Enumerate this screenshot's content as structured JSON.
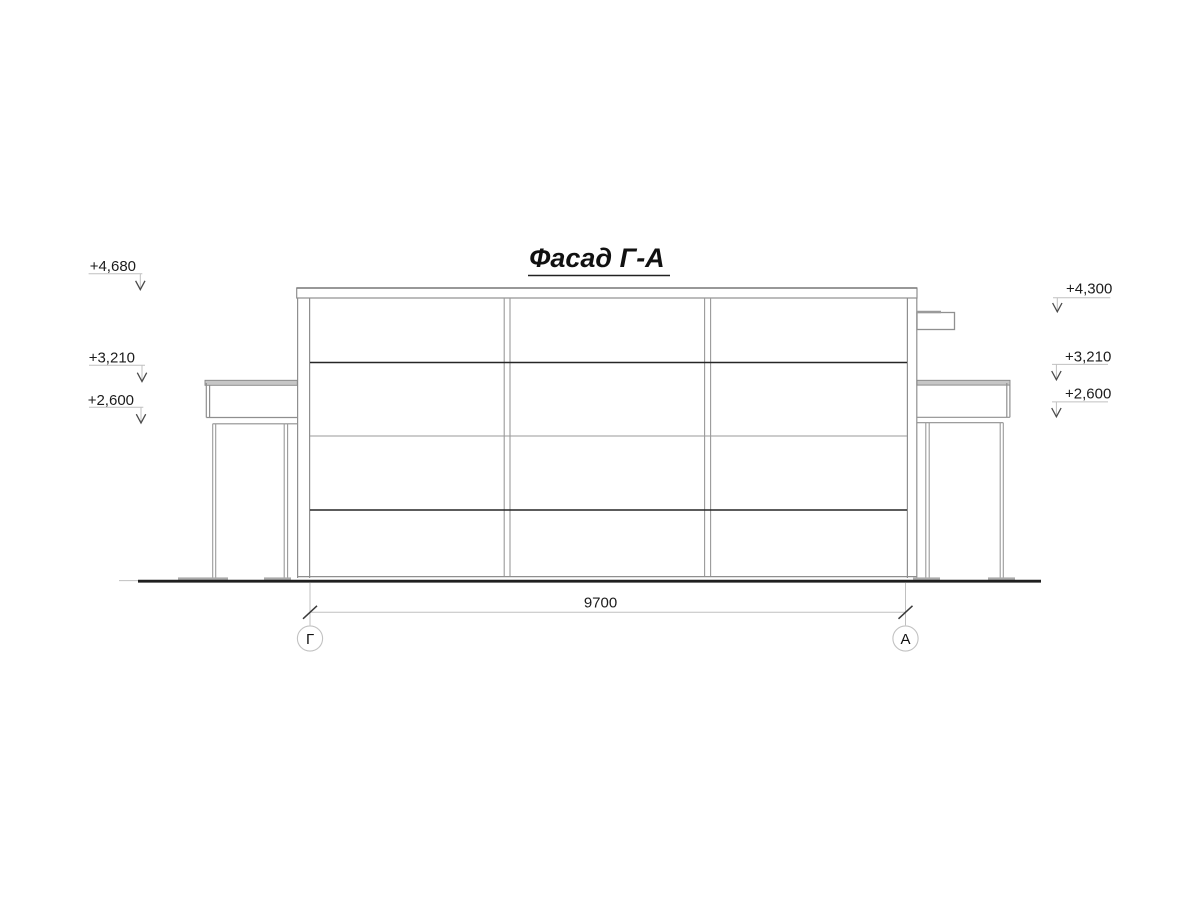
{
  "drawing": {
    "title": "Фасад Г-А",
    "span_dimension": "9700",
    "axes": {
      "left": {
        "label": "Г"
      },
      "right": {
        "label": "А"
      }
    },
    "elevations_left": [
      {
        "label": "+4,680"
      },
      {
        "label": "+3,210"
      },
      {
        "label": "+2,600"
      }
    ],
    "elevations_right": [
      {
        "label": "+4,300"
      },
      {
        "label": "+3,210"
      },
      {
        "label": "+2,600"
      }
    ],
    "colors": {
      "background": "#ffffff",
      "line_dark": "#262626",
      "line_medium": "#8f8f8f",
      "line_light": "#c0c0c0",
      "ground": "#1f1f1f",
      "fascia_fill": "#c6c6c6",
      "text": "#1c1c1c"
    }
  }
}
